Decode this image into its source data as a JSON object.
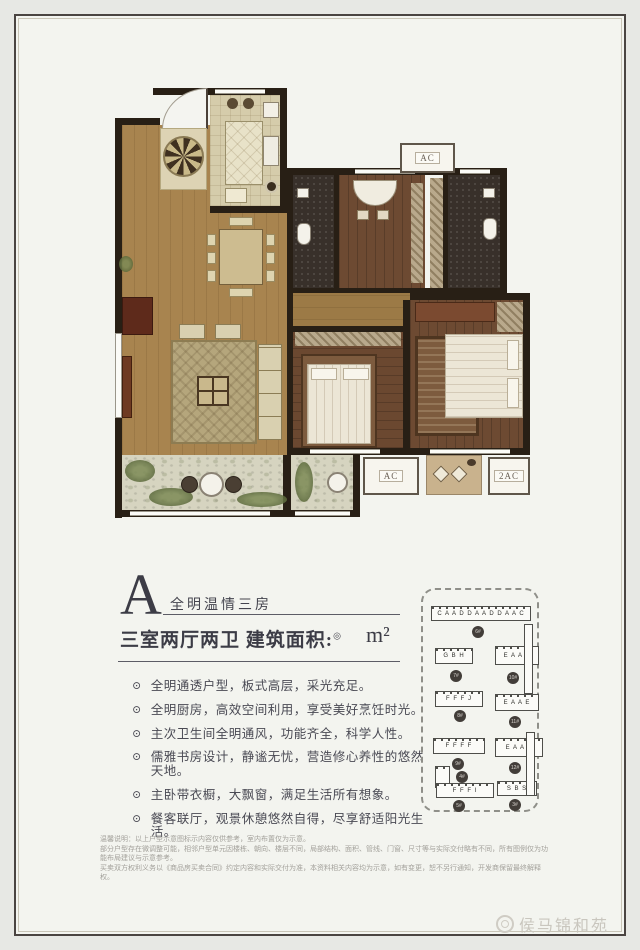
{
  "colors": {
    "page_bg": "#e7e8e4",
    "panel_bg": "#f3f4ef",
    "frame_border": "#4a4441",
    "heading_text": "#3c3c46",
    "body_text": "#4a4a54",
    "muted_text": "#a3a19b",
    "wall": "#281f15",
    "wood_floor": "#a8844f",
    "bedroom_floor": "#6b4830",
    "balcony_floor": "#d6d4c0"
  },
  "floorplan": {
    "ac_top": "AC",
    "ac_bottom_left": "AC",
    "ac_bottom_right": "2AC"
  },
  "heading": {
    "letter": "A",
    "tagline": "全明温情三房",
    "spec": "三室两厅两卫 建筑面积:",
    "spec_mark": "◎",
    "unit": "m²"
  },
  "features": [
    "全明通透户型，板式高层，采光充足。",
    "全明厨房，高效空间利用，享受美好烹饪时光。",
    "主次卫生间全明通风，功能齐全，科学人性。",
    "儒雅书房设计，静谧无忧，营造修心养性的悠然天地。",
    "主卧带衣橱，大飘窗，满足生活所有想象。",
    "餐客联厅，观景休憩悠然自得，尽享舒适阳光生活。"
  ],
  "disclaimer": {
    "line1": "温馨说明：以上户型示意图标示内容仅供参考，室内布置仅为示意。",
    "line2": "部分户型存在微调整可能，相邻户型单元因楼栋、朝向、楼层不同，局部结构、面积、管线、门窗、尺寸等与实际交付略有不同，所有图例仅为功能布局建议与示意参考。",
    "line3": "买卖双方权利义务以《商品房买卖合同》约定内容和实际交付为准，本资料相关内容均为示意，如有变更，恕不另行通知，开发商保留最终解释权。"
  },
  "site_plan": {
    "buildings": [
      {
        "letters": "C A A D D A A D D A A C",
        "badge": "6#"
      },
      {
        "letters": "G B H",
        "badge": "7#"
      },
      {
        "letters": "E A A E",
        "badge": "10#"
      },
      {
        "letters": "F F F J",
        "badge": "8#"
      },
      {
        "letters": "E A A E",
        "badge": "11#"
      },
      {
        "letters": "F F F F",
        "badge": "9#"
      },
      {
        "letters": "",
        "badge": "4#"
      },
      {
        "letters": "E A A E",
        "badge": "12#"
      },
      {
        "letters": "F F F I",
        "badge": "5#"
      },
      {
        "letters": "S B S",
        "badge": "3#"
      }
    ]
  },
  "watermark": {
    "text": "侯马锦和苑"
  }
}
